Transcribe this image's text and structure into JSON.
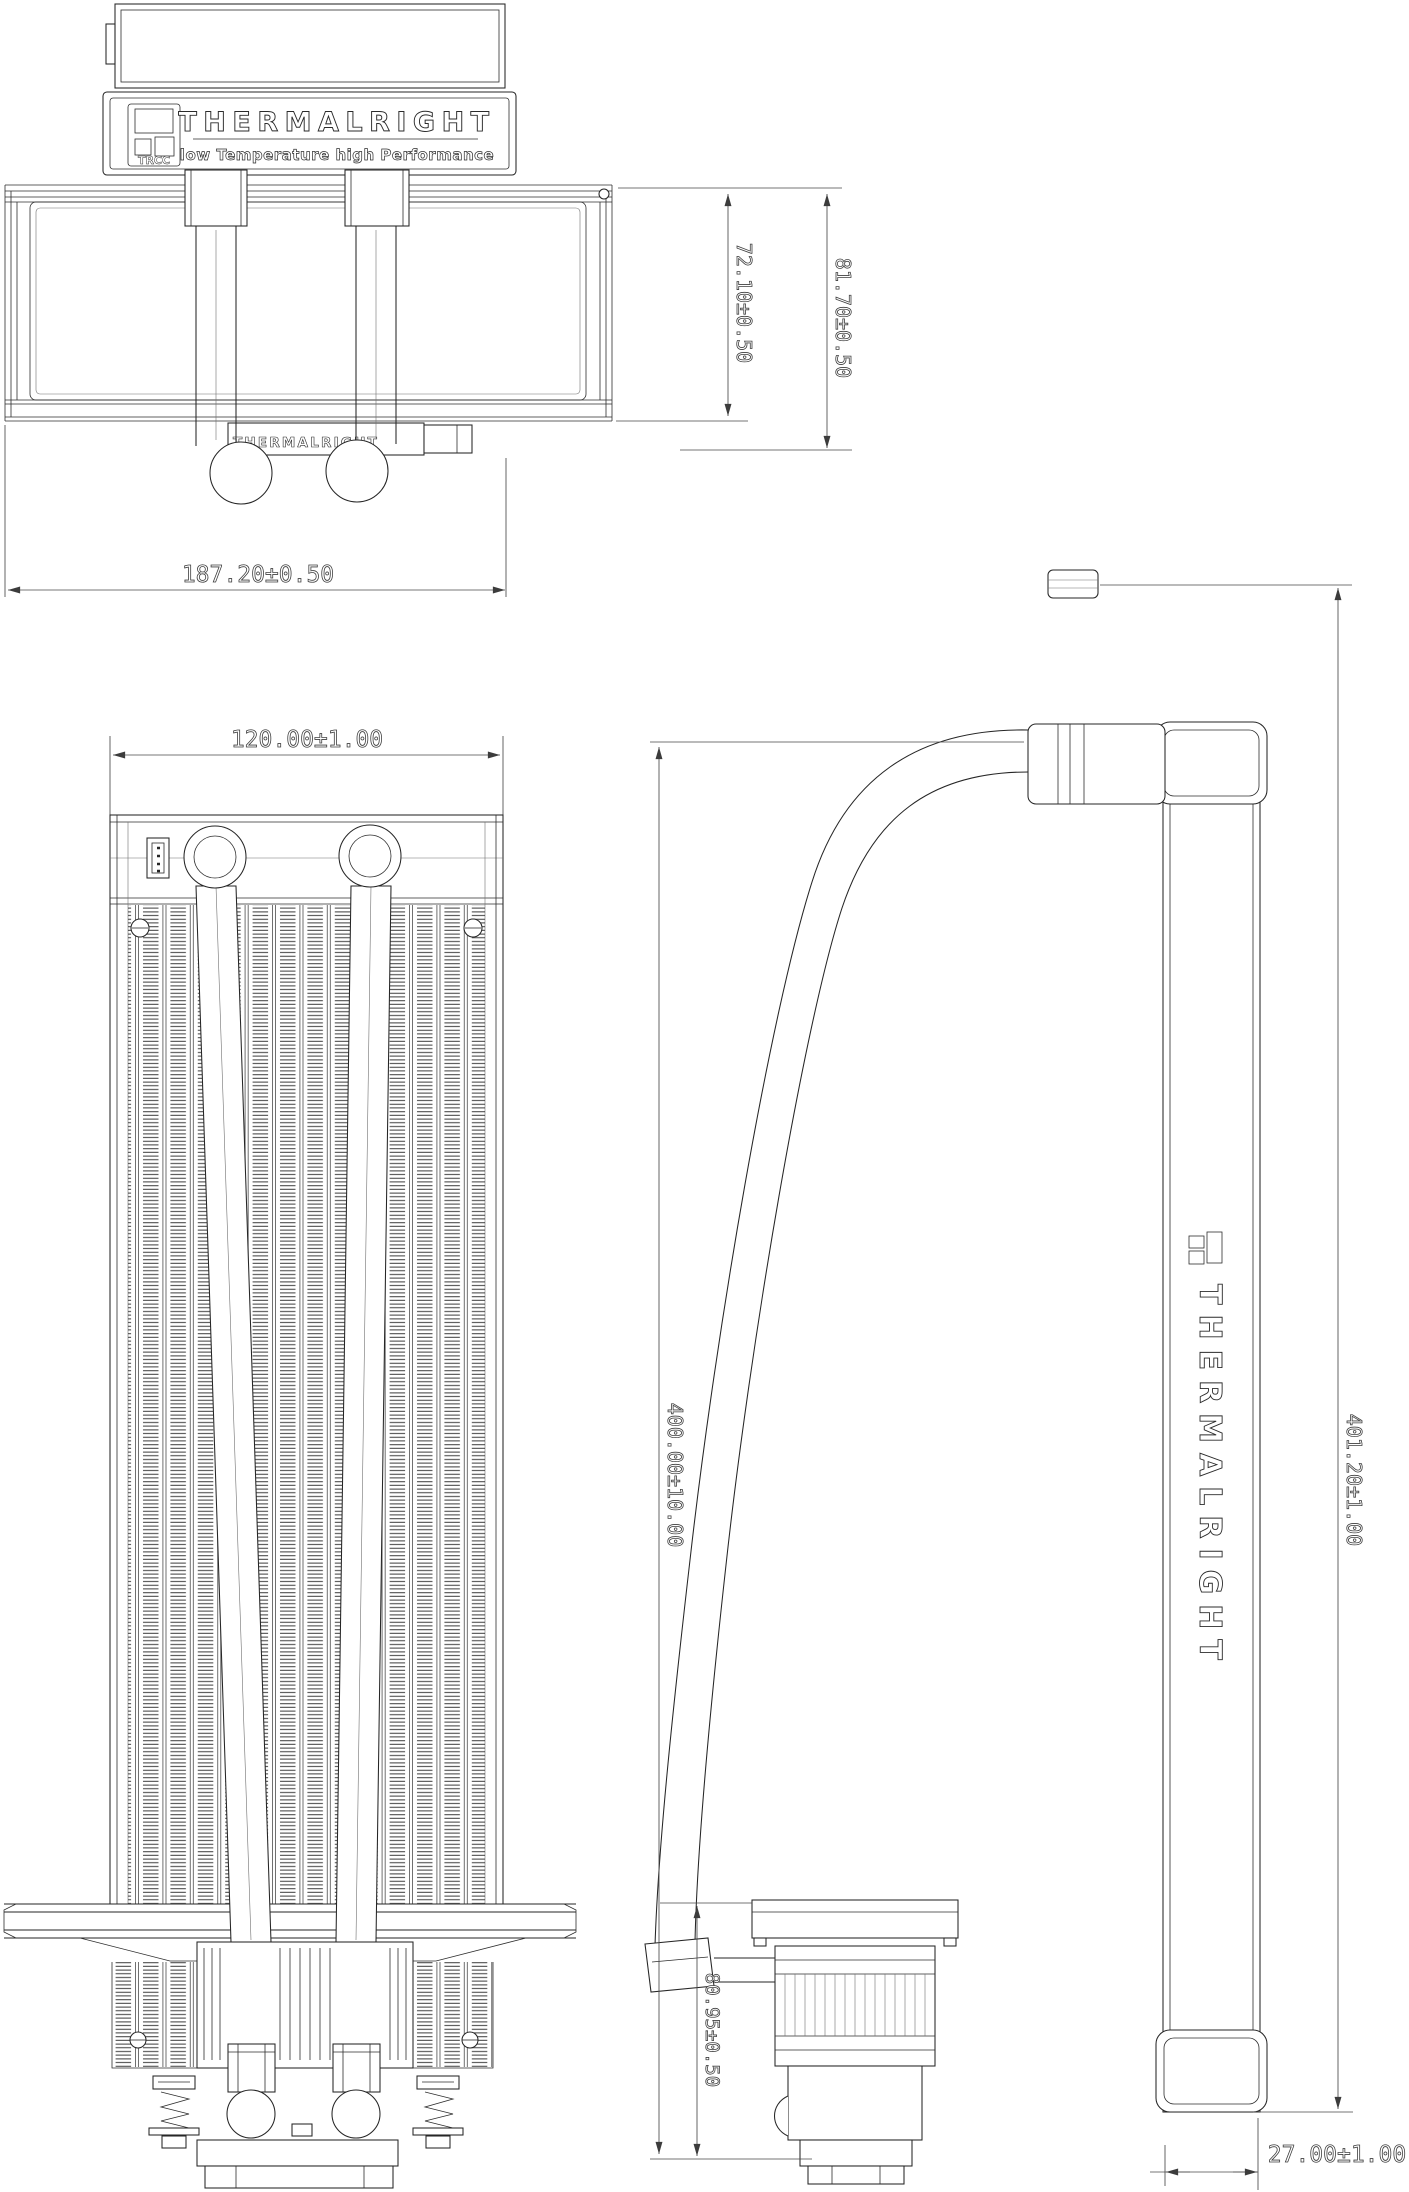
{
  "meta": {
    "background": "#ffffff",
    "line_color": "#262626",
    "dimension_color": "#4a4a4a",
    "drawing_type": "AIO liquid cooler engineering drawing, three views"
  },
  "logo": {
    "brand": "THERMALRIGHT",
    "tagline": "low Temperature high Performance",
    "badge": "TRCC"
  },
  "labels": {
    "radiator_plate": "THERMALRIGHT",
    "side_bar_vertical": "THERMALRIGHT"
  },
  "dimensions": {
    "radiator_height": "72.10±0.50",
    "total_height_top_view": "81.70±0.50",
    "radiator_length": "187.20±0.50",
    "radiator_width": "120.00±1.00",
    "tube_length": "400.00±10.00",
    "overall_height": "401.20±1.00",
    "pump_height": "80.95±0.50",
    "side_thickness": "27.00±1.00"
  }
}
